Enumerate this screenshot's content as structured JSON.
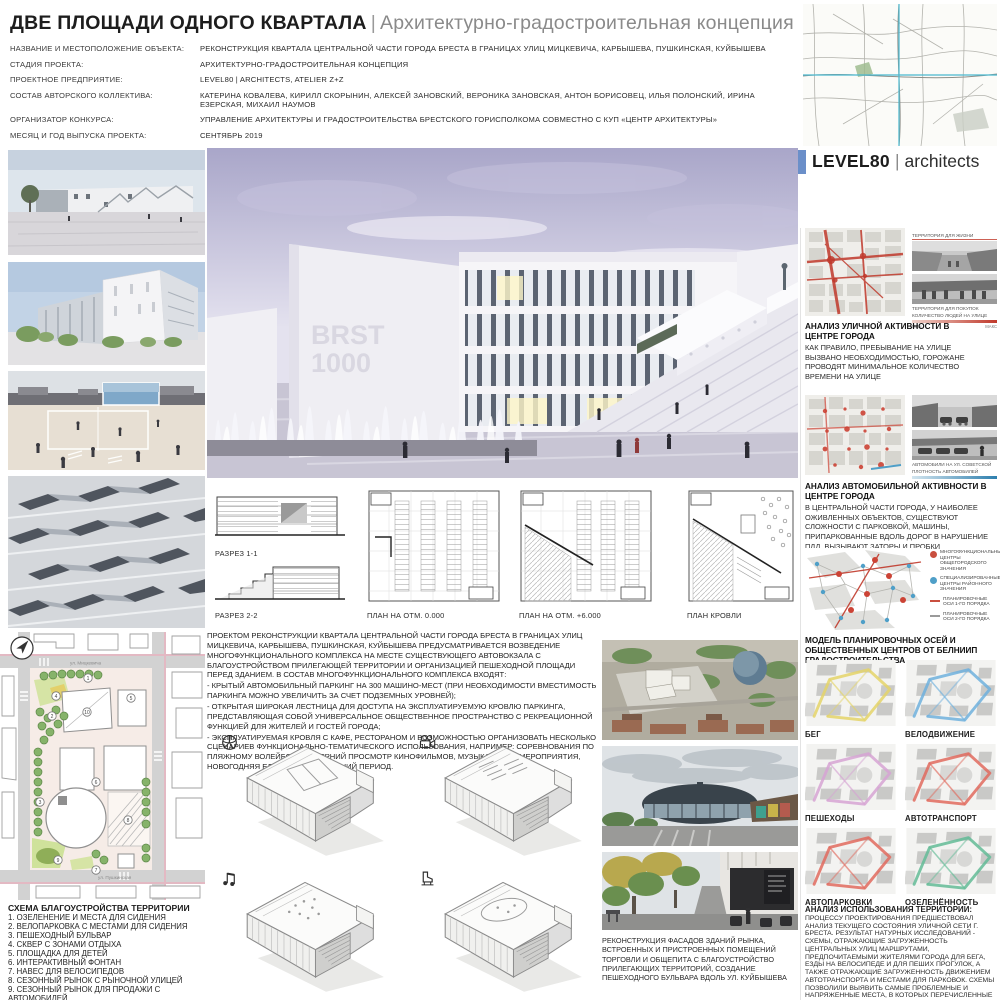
{
  "header": {
    "title": "ДВЕ ПЛОЩАДИ ОДНОГО КВАРТАЛА",
    "divider": "|",
    "subtitle": "Архитектурно-градостроительная концепция",
    "info": [
      {
        "label": "НАЗВАНИЕ И МЕСТОПОЛОЖЕНИЕ ОБЪЕКТА:",
        "value": "РЕКОНСТРУКЦИЯ КВАРТАЛА ЦЕНТРАЛЬНОЙ ЧАСТИ ГОРОДА БРЕСТА В ГРАНИЦАХ УЛИЦ МИЦКЕВИЧА, КАРБЫШЕВА, ПУШКИНСКАЯ, КУЙБЫШЕВА"
      },
      {
        "label": "СТАДИЯ ПРОЕКТА:",
        "value": "АРХИТЕКТУРНО-ГРАДОСТРОИТЕЛЬНАЯ КОНЦЕПЦИЯ"
      },
      {
        "label": "ПРОЕКТНОЕ ПРЕДПРИЯТИЕ:",
        "value": "LEVEL80 | ARCHITECTS, ATELIER Z+Z"
      },
      {
        "label": "СОСТАВ АВТОРСКОГО КОЛЛЕКТИВА:",
        "value": "КАТЕРИНА КОВАЛЕВА, КИРИЛЛ СКОРЫНИН, АЛЕКСЕЙ ЗАНОВСКИЙ, ВЕРОНИКА ЗАНОВСКАЯ, АНТОН БОРИСОВЕЦ, ИЛЬЯ ПОЛОНСКИЙ, ИРИНА ЕЗЕРСКАЯ, МИХАИЛ НАУМОВ"
      },
      {
        "label": "ОРГАНИЗАТОР КОНКУРСА:",
        "value": "УПРАВЛЕНИЕ АРХИТЕКТУРЫ И ГРАДОСТРОИТЕЛЬСТВА БРЕСТСКОГО ГОРИСПОЛКОМА СОВМЕСТНО С КУП «ЦЕНТР АРХИТЕКТУРЫ»"
      },
      {
        "label": "МЕСЯЦ И ГОД ВЫПУСКА ПРОЕКТА:",
        "value": "СЕНТЯБРЬ 2019"
      }
    ],
    "logo": {
      "brand": "LEVEL80",
      "divider": "|",
      "suffix": "architects"
    }
  },
  "main_render": {
    "sign_line1": "BRST",
    "sign_line2": "1000"
  },
  "drawings": {
    "labels": [
      "РАЗРЕЗ 1-1",
      "РАЗРЕЗ 2-2",
      "ПЛАН НА ОТМ. 0.000",
      "ПЛАН НА ОТМ. +6.000",
      "ПЛАН КРОВЛИ"
    ]
  },
  "description": {
    "paragraphs": [
      "ПРОЕКТОМ РЕКОНСТРУКЦИИ КВАРТАЛА ЦЕНТРАЛЬНОЙ ЧАСТИ ГОРОДА БРЕСТА В ГРАНИЦАХ УЛИЦ МИЦКЕВИЧА, КАРБЫШЕВА, ПУШКИНСКАЯ, КУЙБЫШЕВА ПРЕДУСМАТРИВАЕТСЯ ВОЗВЕДЕНИЕ МНОГОФУНКЦИОНАЛЬНОГО КОМПЛЕКСА НА МЕСТЕ СУЩЕСТВУЮЩЕГО АВТОВОКЗАЛА С БЛАГОУСТРОЙСТВОМ ПРИЛЕГАЮЩЕЙ ТЕРРИТОРИИ И ОРГАНИЗАЦИЕЙ ПЕШЕХОДНОЙ ПЛОЩАДИ ПЕРЕД ЗДАНИЕМ. В СОСТАВ МНОГОФУНКЦИОНАЛЬНОГО КОМПЛЕКСА ВХОДЯТ:",
      "- КРЫТЫЙ АВТОМОБИЛЬНЫЙ ПАРКИНГ НА 300 МАШИНО-МЕСТ (ПРИ НЕОБХОДИМОСТИ ВМЕСТИМОСТЬ ПАРКИНГА МОЖНО УВЕЛИЧИТЬ ЗА СЧЕТ ПОДЗЕМНЫХ УРОВНЕЙ);",
      "- ОТКРЫТАЯ ШИРОКАЯ ЛЕСТНИЦА ДЛЯ ДОСТУПА НА ЭКСПЛУАТИРУЕМУЮ КРОВЛЮ ПАРКИНГА, ПРЕДСТАВЛЯЮЩАЯ СОБОЙ УНИВЕРСАЛЬНОЕ ОБЩЕСТВЕННОЕ ПРОСТРАНСТВО С РЕКРЕАЦИОННОЙ ФУНКЦИЕЙ ДЛЯ ЖИТЕЛЕЙ И ГОСТЕЙ ГОРОДА;",
      "- ЭКСПЛУАТИРУЕМАЯ КРОВЛЯ С КАФЕ, РЕСТОРАНОМ И ВОЗМОЖНОСТЬЮ ОРГАНИЗОВАТЬ НЕСКОЛЬКО СЦЕНАРИЕВ ФУНКЦИОНАЛЬНО-ТЕМАТИЧЕСКОГО ИСПОЛЬЗОВАНИЯ, НАПРИМЕР: СОРЕВНОВАНИЯ ПО ПЛЯЖНОМУ ВОЛЕЙБОЛУ, ВЕЧЕРНИЙ ПРОСМОТР КИНОФИЛЬМОВ, МУЗЫКАЛЬНЫЕ МЕРОПРИЯТИЯ, НОВОГОДНЯЯ ЕЛКА И КАТОК В ЗИМНИЙ ПЕРИОД."
    ]
  },
  "siteplan": {
    "title": "СХЕМА БЛАГОУСТРОЙСТВА ТЕРРИТОРИИ",
    "legend": [
      "1. ОЗЕЛЕНЕНИЕ И МЕСТА ДЛЯ СИДЕНИЯ",
      "2. ВЕЛОПАРКОВКА С МЕСТАМИ ДЛЯ СИДЕНИЯ",
      "3. ПЕШЕХОДНЫЙ БУЛЬВАР",
      "4. СКВЕР С ЗОНАМИ ОТДЫХА",
      "5. ПЛОЩАДКА ДЛЯ ДЕТЕЙ",
      "6. ИНТЕРАКТИВНЫЙ ФОНТАН",
      "7. НАВЕС ДЛЯ ВЕЛОСИПЕДОВ",
      "8. СЕЗОННЫЙ РЫНОК С РЫНОЧНОЙ УЛИЦЕЙ",
      "9. СЕЗОННЫЙ РЫНОК ДЛЯ ПРОДАЖИ С АВТОМОБИЛЕЙ",
      "10. МНОГОФУНКЦИОНАЛЬНЫЙ КОМПЛЕКС С ПАРКИНГОМ"
    ],
    "markers": [
      "1",
      "2",
      "3",
      "4",
      "5",
      "6",
      "7",
      "8",
      "9",
      "10"
    ],
    "streets": {
      "top": "ул. Мицкевича",
      "bottom": "ул. Пушкинская"
    }
  },
  "photos": {
    "caption": "РЕКОНСТРУКЦИЯ ФАСАДОВ ЗДАНИЙ РЫНКА, ВСТРОЕННЫХ И ПРИСТРОЕННЫХ ПОМЕЩЕНИЙ ТОРГОВЛИ И ОБЩЕПИТА С БЛАГОУСТРОЙСТВО ПРИЛЕГАЮЩИХ ТЕРРИТОРИЙ, СОЗДАНИЕ ПЕШЕХОДНОГО БУЛЬВАРА ВДОЛЬ УЛ. КУЙБЫШЕВА"
  },
  "analysis_street": {
    "title": "АНАЛИЗ УЛИЧНОЙ АКТИВНОСТИ В ЦЕНТРЕ ГОРОДА",
    "body": "КАК ПРАВИЛО, ПРЕБЫВАНИЕ НА УЛИЦЕ ВЫЗВАНО НЕОБХОДИМОСТЬЮ, ГОРОЖАНЕ ПРОВОДЯТ МИНИМАЛЬНОЕ КОЛИЧЕСТВО ВРЕМЕНИ НА УЛИЦЕ",
    "photo_caption_top": "ТЕРРИТОРИЯ ДЛЯ ЖИЗНИ",
    "photo_caption_bottom": "ТЕРРИТОРИЯ ДЛЯ ПОКУПОК",
    "scale_label": "КОЛИЧЕСТВО ЛЮДЕЙ НА УЛИЦЕ",
    "scale_min": "МИН",
    "scale_max": "МАКС"
  },
  "analysis_auto": {
    "title": "АНАЛИЗ АВТОМОБИЛЬНОЙ АКТИВНОСТИ В ЦЕНТРЕ ГОРОДА",
    "body": "В ЦЕНТРАЛЬНОЙ ЧАСТИ ГОРОДА, У НАИБОЛЕЕ ОЖИВЛЕННЫХ ОБЪЕКТОВ, СУЩЕСТВУЮТ СЛОЖНОСТИ С ПАРКОВКОЙ, МАШИНЫ, ПРИПАРКОВАННЫЕ ВДОЛЬ ДОРОГ В НАРУШЕНИЕ ПДД, ВЫЗЫВАЮТ ЗАТОРЫ И ПРОБКИ",
    "photo_caption": "АВТОМОБИЛИ НА УЛ. СОВЕТСКОЙ",
    "scale_label": "ПЛОТНОСТЬ АВТОМОБИЛЕЙ"
  },
  "model": {
    "caption": "МОДЕЛЬ ПЛАНИРОВОЧНЫХ ОСЕЙ И ОБЩЕСТВЕННЫХ ЦЕНТРОВ ОТ БЕЛНИИП ГРАДОСТРОИТЕЛЬСТВА",
    "legend": [
      {
        "text": "МНОГОФУНКЦИОНАЛЬНЫЕ ЦЕНТРЫ ОБЩЕГОРОДСКОГО ЗНАЧЕНИЯ",
        "color": "#c94f3f"
      },
      {
        "text": "СПЕЦИАЛИЗИРОВАННЫЕ ЦЕНТРЫ РАЙОННОГО ЗНАЧЕНИЯ",
        "color": "#4f9fc8"
      },
      {
        "text": "ПЛАНИРОВОЧНЫЕ ОСИ 1-ГО ПОРЯДКА",
        "color": "#c94f3f"
      },
      {
        "text": "ПЛАНИРОВОЧНЫЕ ОСИ 2-ГО ПОРЯДКА",
        "color": "#9a9a9a"
      }
    ]
  },
  "mobility": {
    "items": [
      {
        "label": "БЕГ",
        "color": "#e4d468"
      },
      {
        "label": "ВЕЛОДВИЖЕНИЕ",
        "color": "#6fb0dd"
      },
      {
        "label": "ПЕШЕХОДЫ",
        "color": "#d6a3d3"
      },
      {
        "label": "АВТОТРАНСПОРТ",
        "color": "#e06a5e"
      },
      {
        "label": "АВТОПАРКОВКИ",
        "color": "#e06a5e"
      },
      {
        "label": "ОЗЕЛЕНЁННОСТЬ",
        "color": "#63bb97"
      }
    ]
  },
  "territory": {
    "title": "АНАЛИЗ ИСПОЛЬЗОВАНИЯ ТЕРРИТОРИИ:",
    "body": "ПРОЦЕССУ ПРОЕКТИРОВАНИЯ ПРЕДШЕСТВОВАЛ АНАЛИЗ ТЕКУЩЕГО СОСТОЯНИЯ УЛИЧНОЙ СЕТИ Г. БРЕСТА. РЕЗУЛЬТАТ НАТУРНЫХ ИССЛЕДОВАНИЙ - СХЕМЫ, ОТРАЖАЮЩИЕ ЗАГРУЖЕННОСТЬ ЦЕНТРАЛЬНЫХ УЛИЦ МАРШРУТАМИ, ПРЕДПОЧИТАЕМЫМИ ЖИТЕЛЯМИ ГОРОДА ДЛЯ БЕГА, ЕЗДЫ НА ВЕЛОСИПЕДЕ И ДЛЯ ПЕШИХ ПРОГУЛОК, А ТАКЖЕ ОТРАЖАЮЩИЕ ЗАГРУЖЕННОСТЬ ДВИЖЕНИЕМ АВТОТРАНСПОРТА И МЕСТАМИ ДЛЯ ПАРКОВОК. СХЕМЫ ПОЗВОЛИЛИ ВЫЯВИТЬ САМЫЕ ПРОБЛЕМНЫЕ И НАПРЯЖЕННЫЕ МЕСТА, В КОТОРЫХ ПЕРЕЧИСЛЕННЫЕ МАРШРУТЫ ПЕРЕСЕКАЮТСЯ."
  },
  "scenario_icons": [
    "volleyball",
    "cinema",
    "music",
    "ice-skating"
  ]
}
